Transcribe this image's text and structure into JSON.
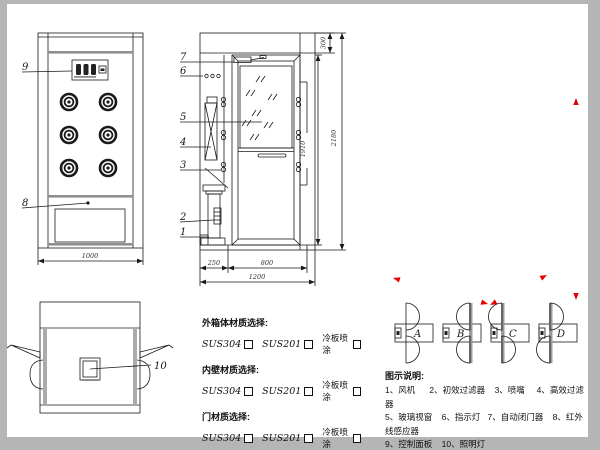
{
  "front_view": {
    "label_control_panel": "9",
    "label_sensor": "8",
    "dim_width": "1000"
  },
  "side_view": {
    "label_door_closer": "7",
    "label_indicator": "6",
    "label_glass": "5",
    "label_hepa": "4",
    "label_nozzle": "3",
    "label_prefilter": "2",
    "label_fan": "1",
    "dim_top": "300",
    "dim_door_height": "1910",
    "dim_total_height": "2180",
    "dim_left": "250",
    "dim_door_width": "800",
    "dim_total_width": "1200"
  },
  "top_view": {
    "label_lamp": "10"
  },
  "photo": {
    "dim_height": "2180mm",
    "dim_width": "1200mm",
    "dim_depth": "1000mm"
  },
  "door_options": {
    "a": "A",
    "b": "B",
    "c": "C",
    "d": "D"
  },
  "materials": {
    "groups": [
      {
        "title": "外箱体材质选择:",
        "opt1": "SUS304",
        "opt2": "SUS201",
        "opt3": "冷板喷涂"
      },
      {
        "title": "内壁材质选择:",
        "opt1": "SUS304",
        "opt2": "SUS201",
        "opt3": "冷板喷涂"
      },
      {
        "title": "门材质选择:",
        "opt1": "SUS304",
        "opt2": "SUS201",
        "opt3": "冷板喷涂"
      }
    ]
  },
  "legend": {
    "title": "图示说明:",
    "line1": "1、风机      2、初效过滤器    3、喷嘴     4、高效过滤器",
    "line2": "5、玻璃视窗    6、指示灯   7、自动闭门器    8、红外线感应器",
    "line3": "9、控制面板    10、照明灯"
  },
  "colors": {
    "dimension_red": "#e60000",
    "line": "#1a1a1a",
    "grille_gray": "#8f8f8f"
  }
}
